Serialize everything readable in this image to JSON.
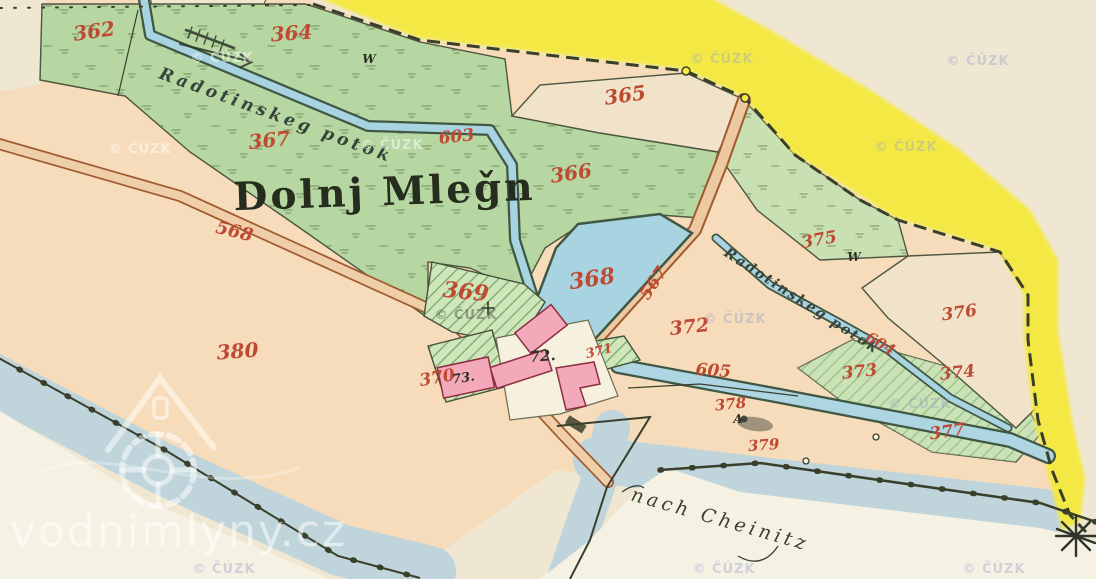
{
  "map": {
    "title": "Dolnj Mleǧn",
    "stream_name": "Radotinskeg potok",
    "direction_note": "nach Cheinitz",
    "copyright_watermark": "© ČÚZK",
    "site_watermark": "vodnimlyny.cz",
    "colors": {
      "road_yellow": "#f5e93c",
      "meadow_green": "#b6d7a1",
      "water_blue": "#a8d3e1",
      "river_blue": "#bfd4db",
      "building_pink": "#f4a9ba",
      "field_peach": "#f6dcba",
      "parcel_number_red": "#bf4a33",
      "ink_dark": "#2c3125"
    },
    "parcel_labels": [
      {
        "name": "parcel-362",
        "text": "362",
        "x": 95,
        "y": 38,
        "rot": -8,
        "size": 20,
        "cls": "red"
      },
      {
        "name": "parcel-364",
        "text": "364",
        "x": 292,
        "y": 40,
        "rot": -4,
        "size": 20,
        "cls": "red"
      },
      {
        "name": "parcel-365",
        "text": "365",
        "x": 626,
        "y": 102,
        "rot": -8,
        "size": 20,
        "cls": "red"
      },
      {
        "name": "parcel-367",
        "text": "367",
        "x": 270,
        "y": 147,
        "rot": -6,
        "size": 20,
        "cls": "red"
      },
      {
        "name": "waterway-603",
        "text": "603",
        "x": 457,
        "y": 142,
        "rot": -6,
        "size": 17,
        "cls": "red"
      },
      {
        "name": "parcel-366",
        "text": "366",
        "x": 572,
        "y": 180,
        "rot": -8,
        "size": 20,
        "cls": "red"
      },
      {
        "name": "road-568",
        "text": "568",
        "x": 233,
        "y": 237,
        "rot": 14,
        "size": 18,
        "cls": "red"
      },
      {
        "name": "parcel-375",
        "text": "375",
        "x": 820,
        "y": 245,
        "rot": -10,
        "size": 17,
        "cls": "red"
      },
      {
        "name": "parcel-368",
        "text": "368",
        "x": 593,
        "y": 286,
        "rot": -8,
        "size": 22,
        "cls": "red"
      },
      {
        "name": "road-567",
        "text": "567",
        "x": 658,
        "y": 286,
        "rot": -56,
        "size": 17,
        "cls": "red"
      },
      {
        "name": "parcel-369",
        "text": "369",
        "x": 465,
        "y": 299,
        "rot": 6,
        "size": 22,
        "cls": "red"
      },
      {
        "name": "parcel-376",
        "text": "376",
        "x": 960,
        "y": 318,
        "rot": -8,
        "size": 17,
        "cls": "red"
      },
      {
        "name": "parcel-372",
        "text": "372",
        "x": 690,
        "y": 333,
        "rot": -6,
        "size": 19,
        "cls": "red"
      },
      {
        "name": "parcel-380",
        "text": "380",
        "x": 238,
        "y": 358,
        "rot": -4,
        "size": 20,
        "cls": "red"
      },
      {
        "name": "waterway-604",
        "text": "604",
        "x": 878,
        "y": 348,
        "rot": 30,
        "size": 15,
        "cls": "red"
      },
      {
        "name": "parcel-371",
        "text": "371",
        "x": 600,
        "y": 355,
        "rot": -14,
        "size": 13,
        "cls": "red"
      },
      {
        "name": "parcel-373",
        "text": "373",
        "x": 860,
        "y": 377,
        "rot": -6,
        "size": 17,
        "cls": "red"
      },
      {
        "name": "parcel-374",
        "text": "374",
        "x": 958,
        "y": 378,
        "rot": -6,
        "size": 17,
        "cls": "red"
      },
      {
        "name": "waterway-605",
        "text": "605",
        "x": 713,
        "y": 376,
        "rot": 4,
        "size": 17,
        "cls": "red"
      },
      {
        "name": "parcel-370",
        "text": "370",
        "x": 438,
        "y": 383,
        "rot": -10,
        "size": 17,
        "cls": "red"
      },
      {
        "name": "parcel-378",
        "text": "378",
        "x": 731,
        "y": 409,
        "rot": -6,
        "size": 15,
        "cls": "red"
      },
      {
        "name": "parcel-377",
        "text": "377",
        "x": 948,
        "y": 437,
        "rot": -8,
        "size": 17,
        "cls": "red"
      },
      {
        "name": "parcel-379",
        "text": "379",
        "x": 764,
        "y": 450,
        "rot": -4,
        "size": 15,
        "cls": "red"
      },
      {
        "name": "meadow-symbol-w-1",
        "text": "W",
        "x": 369,
        "y": 63,
        "rot": 0,
        "size": 12,
        "cls": "blk"
      },
      {
        "name": "meadow-symbol-w-2",
        "text": "W",
        "x": 854,
        "y": 261,
        "rot": 0,
        "size": 12,
        "cls": "blk"
      },
      {
        "name": "house-number-73",
        "text": "73.",
        "x": 464,
        "y": 382,
        "rot": -8,
        "size": 13,
        "cls": "blk"
      },
      {
        "name": "house-number-72",
        "text": "72.",
        "x": 543,
        "y": 361,
        "rot": -5,
        "size": 15,
        "cls": "blk"
      },
      {
        "name": "letter-A",
        "text": "A",
        "x": 738,
        "y": 423,
        "rot": 0,
        "size": 12,
        "cls": "blk"
      }
    ],
    "cuzk_watermarks": [
      {
        "x": 140,
        "y": 153,
        "tone": "w"
      },
      {
        "x": 222,
        "y": 62,
        "tone": "w"
      },
      {
        "x": 392,
        "y": 149,
        "tone": "w"
      },
      {
        "x": 466,
        "y": 319,
        "tone": "g"
      },
      {
        "x": 722,
        "y": 63,
        "tone": "b"
      },
      {
        "x": 978,
        "y": 65,
        "tone": "b"
      },
      {
        "x": 906,
        "y": 151,
        "tone": "b"
      },
      {
        "x": 735,
        "y": 323,
        "tone": "b"
      },
      {
        "x": 920,
        "y": 408,
        "tone": "b"
      },
      {
        "x": 224,
        "y": 573,
        "tone": "b"
      },
      {
        "x": 724,
        "y": 573,
        "tone": "b"
      },
      {
        "x": 994,
        "y": 573,
        "tone": "b"
      }
    ]
  }
}
